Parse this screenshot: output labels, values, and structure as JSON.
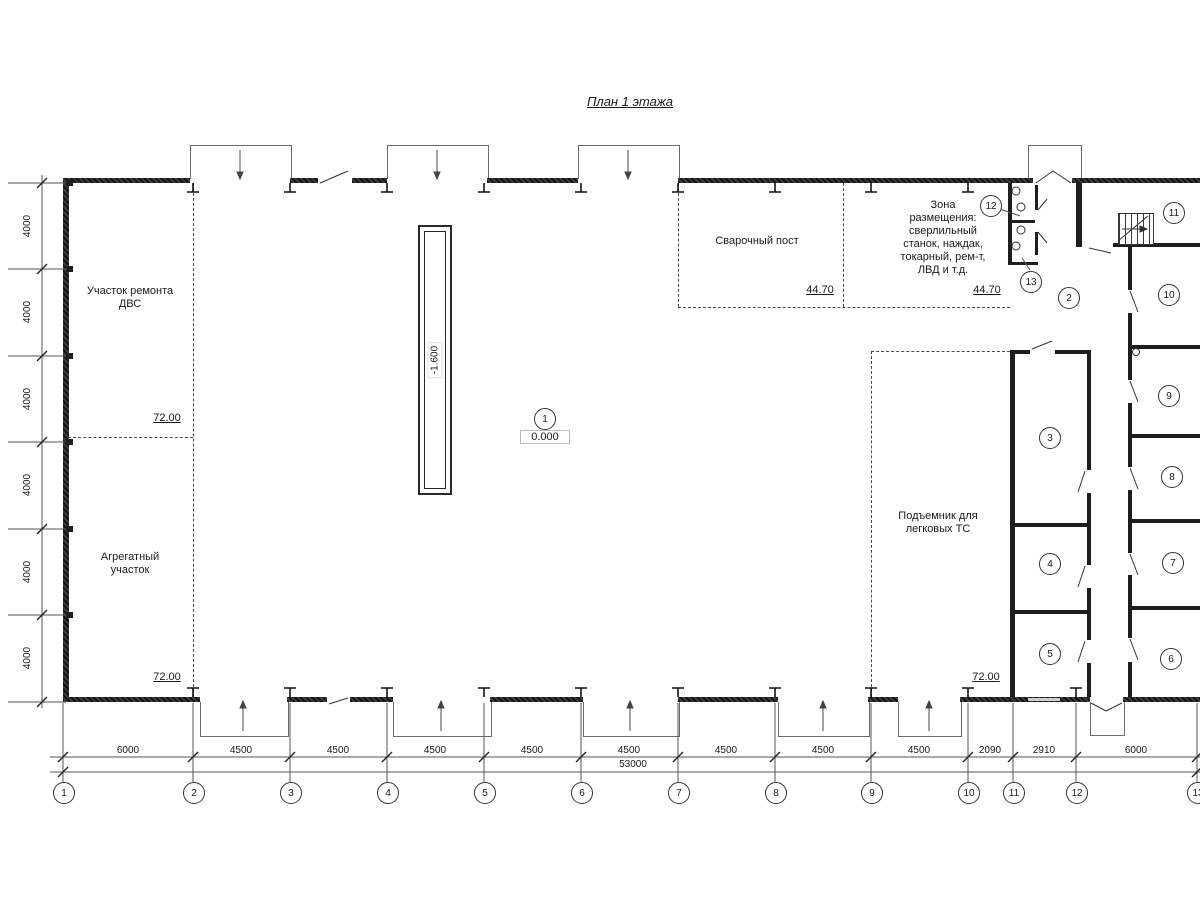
{
  "title": "План 1 этажа",
  "rooms": {
    "engine_repair": {
      "label": "Участок ремонта\nДВС",
      "area": "72.00"
    },
    "aggregate": {
      "label": "Агрегатный\nучасток",
      "area": "72.00"
    },
    "welding": {
      "label": "Сварочный пост",
      "area": "44.70"
    },
    "equipment_zone": {
      "label": "Зона\nразмещения:\nсверлильный\nстанок, наждак,\nтокарный, рем-т,\nЛВД и т.д.",
      "area": "44.70"
    },
    "car_lift": {
      "label": "Подъемник для\nлегковых ТС",
      "area": "72.00"
    }
  },
  "elevations": {
    "ground": "0.000",
    "pit": "-1.600"
  },
  "room_numbers": [
    "1",
    "2",
    "3",
    "4",
    "5",
    "6",
    "7",
    "8",
    "9",
    "10",
    "11",
    "12",
    "13"
  ],
  "axis_numbers": [
    "1",
    "2",
    "3",
    "4",
    "5",
    "6",
    "7",
    "8",
    "9",
    "10",
    "11",
    "12",
    "13"
  ],
  "dimensions": {
    "bottom": [
      "6000",
      "4500",
      "4500",
      "4500",
      "4500",
      "4500",
      "4500",
      "4500",
      "4500",
      "2090",
      "2910",
      "6000"
    ],
    "total": "53000",
    "left": [
      "4000",
      "4000",
      "4000",
      "4000",
      "4000",
      "4000"
    ]
  }
}
